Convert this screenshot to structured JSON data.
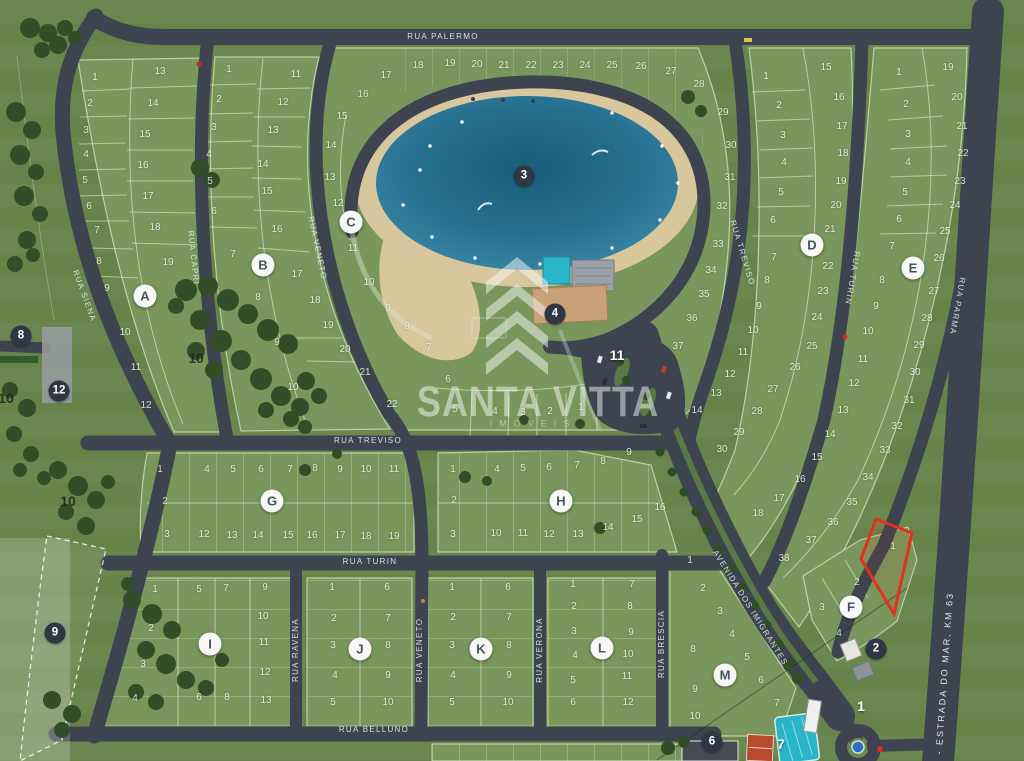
{
  "watermark": {
    "brand": "SANTA VITTA",
    "tagline": "IMÓVEIS"
  },
  "colors": {
    "highlight": "#e2321e",
    "road": "#3d444f",
    "lake": "#2a7fa0",
    "block": "#79965c"
  },
  "streets": [
    {
      "name": "RUA PALERMO",
      "x": 443,
      "y": 37,
      "angle": 0
    },
    {
      "name": "RUA SIENA",
      "x": 84,
      "y": 296,
      "angle": 70
    },
    {
      "name": "RUA CAPRI",
      "x": 193,
      "y": 258,
      "angle": 84
    },
    {
      "name": "RUA VENETO",
      "x": 317,
      "y": 248,
      "angle": 78
    },
    {
      "name": "RUA TREVISO",
      "x": 368,
      "y": 441,
      "angle": 0
    },
    {
      "name": "RUA TURIN",
      "x": 370,
      "y": 562,
      "angle": 0
    },
    {
      "name": "RUA BELLUNO",
      "x": 374,
      "y": 730,
      "angle": 0
    },
    {
      "name": "RUA RAVENA",
      "x": 296,
      "y": 650,
      "angle": -90
    },
    {
      "name": "RUA VENETO",
      "x": 420,
      "y": 650,
      "angle": -90
    },
    {
      "name": "RUA VERONA",
      "x": 540,
      "y": 650,
      "angle": -90
    },
    {
      "name": "RUA BRESCIA",
      "x": 662,
      "y": 644,
      "angle": -90
    },
    {
      "name": "RUA TREVISO",
      "x": 742,
      "y": 253,
      "angle": 73
    },
    {
      "name": "RUA TURIN",
      "x": 852,
      "y": 278,
      "angle": 100
    },
    {
      "name": "RUA PARMA",
      "x": 957,
      "y": 306,
      "angle": 100
    },
    {
      "name": "AVENIDA DOS IMIGRANTES",
      "x": 750,
      "y": 608,
      "angle": 58
    },
    {
      "name": "389 - ESTRADA DO MAR, KM 63",
      "x": 944,
      "y": 686,
      "angle": -86,
      "cls": "estrada"
    }
  ],
  "blocks": [
    {
      "id": "A",
      "marker": {
        "x": 145,
        "y": 296
      },
      "lots": [
        [
          1,
          95,
          78
        ],
        [
          2,
          90,
          104
        ],
        [
          3,
          86,
          131
        ],
        [
          4,
          86,
          155
        ],
        [
          5,
          85,
          181
        ],
        [
          6,
          89,
          207
        ],
        [
          7,
          97,
          231
        ],
        [
          8,
          99,
          262
        ],
        [
          9,
          107,
          289
        ],
        [
          10,
          125,
          333
        ],
        [
          11,
          136,
          368
        ],
        [
          12,
          146,
          406
        ],
        [
          13,
          160,
          72
        ],
        [
          14,
          153,
          104
        ],
        [
          15,
          145,
          135
        ],
        [
          16,
          143,
          166
        ],
        [
          17,
          148,
          197
        ],
        [
          18,
          155,
          228
        ],
        [
          19,
          168,
          263
        ]
      ]
    },
    {
      "id": "B",
      "marker": {
        "x": 263,
        "y": 265
      },
      "lots": [
        [
          1,
          229,
          70
        ],
        [
          2,
          219,
          100
        ],
        [
          3,
          214,
          128
        ],
        [
          4,
          209,
          155
        ],
        [
          5,
          210,
          182
        ],
        [
          6,
          214,
          212
        ],
        [
          7,
          233,
          255
        ],
        [
          8,
          258,
          298
        ],
        [
          9,
          277,
          343
        ],
        [
          10,
          293,
          388
        ],
        [
          11,
          296,
          75
        ],
        [
          12,
          283,
          103
        ],
        [
          13,
          273,
          131
        ],
        [
          14,
          263,
          165
        ],
        [
          15,
          267,
          192
        ],
        [
          16,
          277,
          230
        ],
        [
          17,
          297,
          275
        ],
        [
          18,
          315,
          301
        ],
        [
          19,
          328,
          326
        ],
        [
          20,
          345,
          350
        ],
        [
          21,
          365,
          373
        ],
        [
          22,
          392,
          405
        ]
      ]
    },
    {
      "id": "C",
      "marker": {
        "x": 351,
        "y": 222
      },
      "lots": [
        [
          1,
          581,
          408
        ],
        [
          2,
          550,
          412
        ],
        [
          3,
          523,
          413
        ],
        [
          4,
          495,
          412
        ],
        [
          5,
          455,
          410
        ],
        [
          6,
          448,
          380
        ],
        [
          7,
          429,
          348
        ],
        [
          8,
          407,
          327
        ],
        [
          9,
          388,
          309
        ],
        [
          10,
          369,
          283
        ],
        [
          11,
          353,
          249
        ],
        [
          12,
          338,
          204
        ],
        [
          13,
          330,
          178
        ],
        [
          14,
          331,
          146
        ],
        [
          15,
          342,
          117
        ],
        [
          16,
          363,
          95
        ],
        [
          17,
          386,
          76
        ],
        [
          18,
          418,
          66
        ],
        [
          19,
          450,
          64
        ],
        [
          20,
          477,
          65
        ],
        [
          21,
          504,
          66
        ],
        [
          22,
          531,
          66
        ],
        [
          23,
          558,
          66
        ],
        [
          24,
          585,
          66
        ],
        [
          25,
          612,
          66
        ],
        [
          26,
          641,
          67
        ],
        [
          27,
          671,
          72
        ],
        [
          28,
          699,
          85
        ],
        [
          29,
          723,
          113
        ],
        [
          30,
          731,
          146
        ],
        [
          31,
          730,
          178
        ],
        [
          32,
          722,
          207
        ],
        [
          33,
          718,
          245
        ],
        [
          34,
          711,
          271
        ],
        [
          35,
          704,
          295
        ],
        [
          36,
          692,
          319
        ],
        [
          37,
          678,
          347
        ]
      ]
    },
    {
      "id": "D",
      "marker": {
        "x": 812,
        "y": 245
      },
      "lots": [
        [
          1,
          766,
          77
        ],
        [
          2,
          779,
          106
        ],
        [
          3,
          783,
          136
        ],
        [
          4,
          784,
          163
        ],
        [
          5,
          781,
          193
        ],
        [
          6,
          773,
          221
        ],
        [
          7,
          774,
          258
        ],
        [
          8,
          767,
          281
        ],
        [
          9,
          759,
          307
        ],
        [
          10,
          753,
          331
        ],
        [
          11,
          743,
          353
        ],
        [
          12,
          730,
          375
        ],
        [
          13,
          716,
          394
        ],
        [
          14,
          697,
          411
        ],
        [
          15,
          826,
          68
        ],
        [
          16,
          839,
          98
        ],
        [
          17,
          842,
          127
        ],
        [
          18,
          843,
          154
        ],
        [
          19,
          841,
          182
        ],
        [
          20,
          836,
          206
        ],
        [
          21,
          830,
          230
        ],
        [
          22,
          828,
          267
        ],
        [
          23,
          823,
          292
        ],
        [
          24,
          817,
          318
        ],
        [
          25,
          812,
          347
        ],
        [
          26,
          795,
          368
        ],
        [
          27,
          773,
          390
        ],
        [
          28,
          757,
          412
        ],
        [
          29,
          739,
          433
        ],
        [
          30,
          722,
          450
        ]
      ]
    },
    {
      "id": "E",
      "marker": {
        "x": 913,
        "y": 268
      },
      "lots": [
        [
          1,
          899,
          73
        ],
        [
          2,
          906,
          105
        ],
        [
          3,
          908,
          135
        ],
        [
          4,
          908,
          163
        ],
        [
          5,
          905,
          193
        ],
        [
          6,
          899,
          220
        ],
        [
          7,
          892,
          247
        ],
        [
          8,
          882,
          281
        ],
        [
          9,
          876,
          307
        ],
        [
          10,
          868,
          332
        ],
        [
          11,
          863,
          360
        ],
        [
          12,
          854,
          384
        ],
        [
          13,
          843,
          411
        ],
        [
          14,
          830,
          435
        ],
        [
          15,
          817,
          458
        ],
        [
          16,
          800,
          480
        ],
        [
          17,
          779,
          499
        ],
        [
          18,
          758,
          514
        ],
        [
          19,
          948,
          68
        ],
        [
          20,
          957,
          98
        ],
        [
          21,
          962,
          127
        ],
        [
          22,
          963,
          154
        ],
        [
          23,
          960,
          182
        ],
        [
          24,
          955,
          206
        ],
        [
          25,
          945,
          232
        ],
        [
          26,
          939,
          259
        ],
        [
          27,
          934,
          292
        ],
        [
          28,
          927,
          319
        ],
        [
          29,
          919,
          346
        ],
        [
          30,
          915,
          373
        ],
        [
          31,
          909,
          401
        ],
        [
          32,
          897,
          427
        ],
        [
          33,
          885,
          451
        ],
        [
          34,
          868,
          478
        ],
        [
          35,
          852,
          503
        ],
        [
          36,
          833,
          523
        ],
        [
          37,
          811,
          541
        ],
        [
          38,
          784,
          559
        ]
      ]
    },
    {
      "id": "F",
      "marker": {
        "x": 851,
        "y": 607
      },
      "lots": [
        [
          1,
          893,
          547
        ],
        [
          2,
          857,
          583
        ],
        [
          3,
          822,
          608
        ],
        [
          4,
          839,
          634
        ]
      ]
    },
    {
      "id": "G",
      "marker": {
        "x": 272,
        "y": 501
      },
      "lots": [
        [
          1,
          160,
          470
        ],
        [
          2,
          165,
          502
        ],
        [
          3,
          167,
          535
        ],
        [
          4,
          207,
          470
        ],
        [
          5,
          233,
          470
        ],
        [
          6,
          261,
          470
        ],
        [
          7,
          290,
          470
        ],
        [
          8,
          315,
          469
        ],
        [
          9,
          340,
          470
        ],
        [
          10,
          366,
          470
        ],
        [
          11,
          394,
          470
        ],
        [
          12,
          204,
          535
        ],
        [
          13,
          232,
          536
        ],
        [
          14,
          258,
          536
        ],
        [
          15,
          288,
          536
        ],
        [
          16,
          312,
          536
        ],
        [
          17,
          340,
          536
        ],
        [
          18,
          366,
          537
        ],
        [
          19,
          394,
          537
        ]
      ]
    },
    {
      "id": "H",
      "marker": {
        "x": 561,
        "y": 501
      },
      "lots": [
        [
          1,
          453,
          470
        ],
        [
          2,
          454,
          501
        ],
        [
          3,
          453,
          535
        ],
        [
          4,
          497,
          470
        ],
        [
          5,
          523,
          469
        ],
        [
          6,
          549,
          468
        ],
        [
          7,
          577,
          466
        ],
        [
          8,
          603,
          462
        ],
        [
          9,
          629,
          453
        ],
        [
          10,
          496,
          534
        ],
        [
          11,
          523,
          534
        ],
        [
          12,
          549,
          535
        ],
        [
          13,
          578,
          535
        ],
        [
          14,
          608,
          528
        ],
        [
          15,
          637,
          520
        ],
        [
          16,
          660,
          508
        ]
      ]
    },
    {
      "id": "I",
      "marker": {
        "x": 210,
        "y": 644
      },
      "lots": [
        [
          1,
          155,
          590
        ],
        [
          2,
          151,
          629
        ],
        [
          3,
          143,
          665
        ],
        [
          4,
          135,
          699
        ],
        [
          5,
          199,
          590
        ],
        [
          6,
          199,
          698
        ],
        [
          7,
          226,
          589
        ],
        [
          8,
          227,
          698
        ],
        [
          9,
          265,
          588
        ],
        [
          10,
          263,
          617
        ],
        [
          11,
          264,
          643
        ],
        [
          12,
          265,
          673
        ],
        [
          13,
          266,
          701
        ]
      ]
    },
    {
      "id": "J",
      "marker": {
        "x": 360,
        "y": 649
      },
      "lots": [
        [
          1,
          332,
          588
        ],
        [
          2,
          334,
          619
        ],
        [
          3,
          333,
          646
        ],
        [
          4,
          335,
          676
        ],
        [
          5,
          333,
          703
        ],
        [
          6,
          387,
          588
        ],
        [
          7,
          388,
          619
        ],
        [
          8,
          388,
          646
        ],
        [
          9,
          388,
          676
        ],
        [
          10,
          388,
          703
        ]
      ]
    },
    {
      "id": "K",
      "marker": {
        "x": 481,
        "y": 649
      },
      "lots": [
        [
          1,
          452,
          588
        ],
        [
          2,
          453,
          618
        ],
        [
          3,
          452,
          646
        ],
        [
          4,
          453,
          676
        ],
        [
          5,
          452,
          703
        ],
        [
          6,
          508,
          588
        ],
        [
          7,
          509,
          618
        ],
        [
          8,
          509,
          646
        ],
        [
          9,
          509,
          676
        ],
        [
          10,
          508,
          703
        ]
      ]
    },
    {
      "id": "L",
      "marker": {
        "x": 602,
        "y": 648
      },
      "lots": [
        [
          1,
          573,
          585
        ],
        [
          2,
          574,
          607
        ],
        [
          3,
          574,
          632
        ],
        [
          4,
          575,
          656
        ],
        [
          5,
          573,
          681
        ],
        [
          6,
          573,
          703
        ],
        [
          7,
          632,
          585
        ],
        [
          8,
          630,
          607
        ],
        [
          9,
          631,
          633
        ],
        [
          10,
          628,
          655
        ],
        [
          11,
          627,
          677
        ],
        [
          12,
          628,
          703
        ]
      ]
    },
    {
      "id": "M",
      "marker": {
        "x": 725,
        "y": 675
      },
      "lots": [
        [
          1,
          690,
          561
        ],
        [
          2,
          703,
          589
        ],
        [
          3,
          720,
          612
        ],
        [
          4,
          732,
          635
        ],
        [
          5,
          747,
          658
        ],
        [
          6,
          761,
          681
        ],
        [
          7,
          777,
          704
        ],
        [
          8,
          693,
          650
        ],
        [
          9,
          695,
          690
        ],
        [
          10,
          695,
          717
        ]
      ]
    }
  ],
  "poi_dark": [
    {
      "n": "3",
      "x": 524,
      "y": 176
    },
    {
      "n": "4",
      "x": 555,
      "y": 314
    },
    {
      "n": "8",
      "x": 21,
      "y": 336
    },
    {
      "n": "12",
      "x": 59,
      "y": 391
    },
    {
      "n": "9",
      "x": 55,
      "y": 633
    },
    {
      "n": "2",
      "x": 876,
      "y": 649
    },
    {
      "n": "6",
      "x": 712,
      "y": 742
    }
  ],
  "poi_light": [
    {
      "n": "11",
      "x": 617,
      "y": 355
    },
    {
      "n": "1",
      "x": 861,
      "y": 706
    },
    {
      "n": "7",
      "x": 781,
      "y": 744
    }
  ],
  "area_labels": [
    {
      "n": "10",
      "x": 196,
      "y": 358
    },
    {
      "n": "10",
      "x": 6,
      "y": 398
    },
    {
      "n": "10",
      "x": 68,
      "y": 501
    }
  ],
  "highlight_lot": {
    "block": "F",
    "lot": "1",
    "color": "#e2321e"
  }
}
